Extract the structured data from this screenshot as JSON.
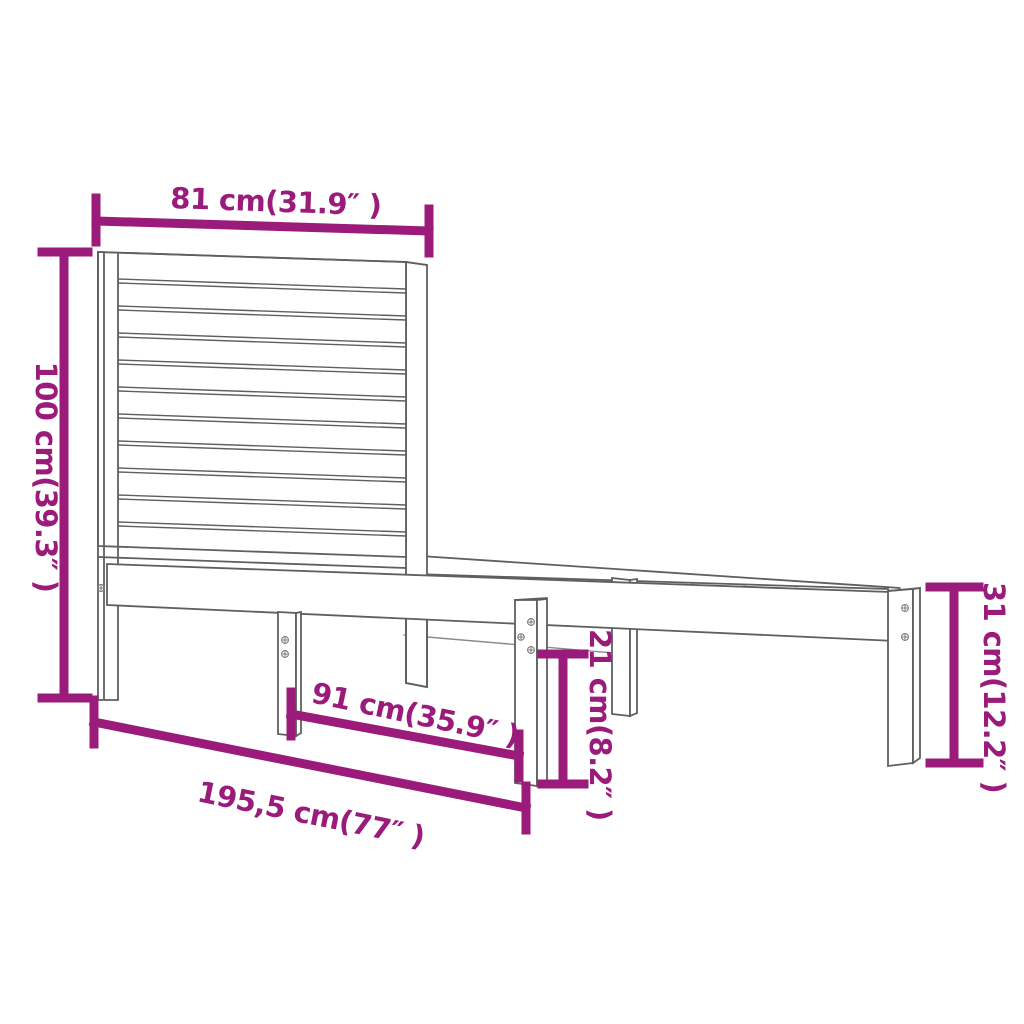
{
  "diagram": {
    "type": "product-dimension-diagram",
    "subject": "wooden bed frame with slatted headboard",
    "background_color": "#ffffff",
    "accent_color": "#9B1B7B",
    "outline_color": "#5f5f5f",
    "dimensions": {
      "headboard_width": {
        "label": "81 cm(31.9″ )",
        "cm": "81",
        "inches": "31.9"
      },
      "headboard_height": {
        "label": "100 cm(39.3″ )",
        "cm": "100",
        "inches": "39.3"
      },
      "foot_end_height": {
        "label": "31 cm(12.2″ )",
        "cm": "31",
        "inches": "12.2"
      },
      "rail_to_floor_height": {
        "label": "21 cm(8.2″ )",
        "cm": "21",
        "inches": "8.2"
      },
      "leg_spacing": {
        "label": "91 cm(35.9″ )",
        "cm": "91",
        "inches": "35.9"
      },
      "total_length": {
        "label": "195,5 cm(77″ )",
        "cm": "195,5",
        "inches": "77"
      }
    }
  }
}
